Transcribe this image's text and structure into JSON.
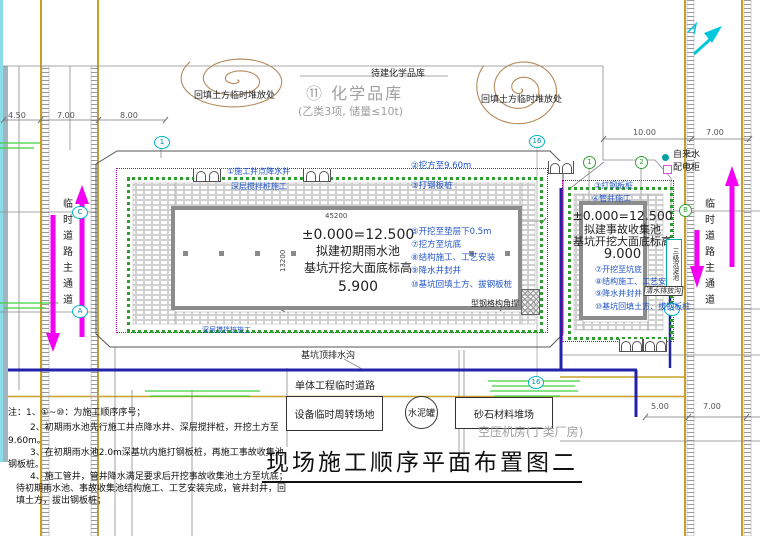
{
  "title": "现场施工顺序平面布置图二",
  "colors": {
    "road_yellow": "#C8A028",
    "arrow_magenta": "#F400F4",
    "note_blue": "#2356C8",
    "drain_navy": "#2222AA",
    "green_band": "#2E9E2E",
    "cyan": "#00C8DC"
  },
  "top": {
    "pending_label": "待建化学品库",
    "chem_store": "⑪ 化学品库",
    "chem_store_sub": "(乙类3项, 储量≤10t)",
    "stockpile_left": "回填土方临时堆放处",
    "stockpile_right": "回填土方临时堆放处"
  },
  "legend": {
    "water": "自来水",
    "power": "配电柜"
  },
  "dims": {
    "d450": "4.50",
    "d700a": "7.00",
    "d800": "8.00",
    "d1000": "10.00",
    "d700b": "7.00",
    "d500": "5.00",
    "d700c": "7.00",
    "w45200": "45200",
    "h13200": "13200"
  },
  "grid": {
    "b1": "1",
    "b16t": "16",
    "b16b": "16",
    "g1": "1",
    "g2": "2",
    "bB": "B",
    "bC": "C",
    "bA": "A",
    "bA2": "A"
  },
  "pool_main": {
    "elev": "±0.000=12.500",
    "name": "拟建初期雨水池",
    "sub": "基坑开挖大面底标高",
    "value": "5.900",
    "label_wellpoint": "①施工井点降水井",
    "label_mixpile": "深层搅拌桩施工",
    "label_excavate": "②挖方至9.60m",
    "label_sheetpile": "③打钢板桩",
    "label_mixpile2": "深层搅拌桩施工",
    "label_brace": "型钢格构角撑",
    "steps": [
      "⑤开挖至垫层下0.5m",
      "⑦挖方至坑底",
      "⑧结构施工、工艺安装",
      "⑨降水井封井",
      "⑩基坑回填土方、拔钢板桩"
    ]
  },
  "pool_acc": {
    "elev": "±0.000=12.500",
    "name": "拟建事故收集池",
    "sub": "基坑开挖大面底标高",
    "value": "9.000",
    "label_sheetpile": "③打钢板桩",
    "label_well": "④管井施工",
    "steps": [
      "⑦开挖至坑底",
      "⑧结构施工、工艺安装",
      "⑨降水井封井",
      "⑩基坑回填土方、拔钢板桩"
    ],
    "sediment": "三级沉淀池",
    "drain_label": "清水排放沟"
  },
  "roads": {
    "left": "临时道路主通道",
    "right": "临时道路主通道",
    "unit_road": "单体工程临时道路",
    "pit_drain": "基坑顶排水沟"
  },
  "facilities": {
    "equipment": "设备临时周转场地",
    "cement": "水泥罐",
    "sand": "砂石材料堆场",
    "compressor": "空压机房(丁类厂房)"
  },
  "notes": [
    "注：1、①~⑩：为施工顺序序号；",
    "2、初期雨水池先行施工井点降水井、深层搅拌桩，开挖土方至",
    "9.60m。",
    "3、在初期雨水池2.0m深基坑内施打钢板桩，再施工事故收集池",
    "钢板桩。",
    "4、施工管井，管井降水满足要求后开挖事故收集池土方至坑底；",
    "待初期雨水池、事故收集池结构施工、工艺安装完成，管井封井，回",
    "填土方，拔出钢板桩；"
  ]
}
